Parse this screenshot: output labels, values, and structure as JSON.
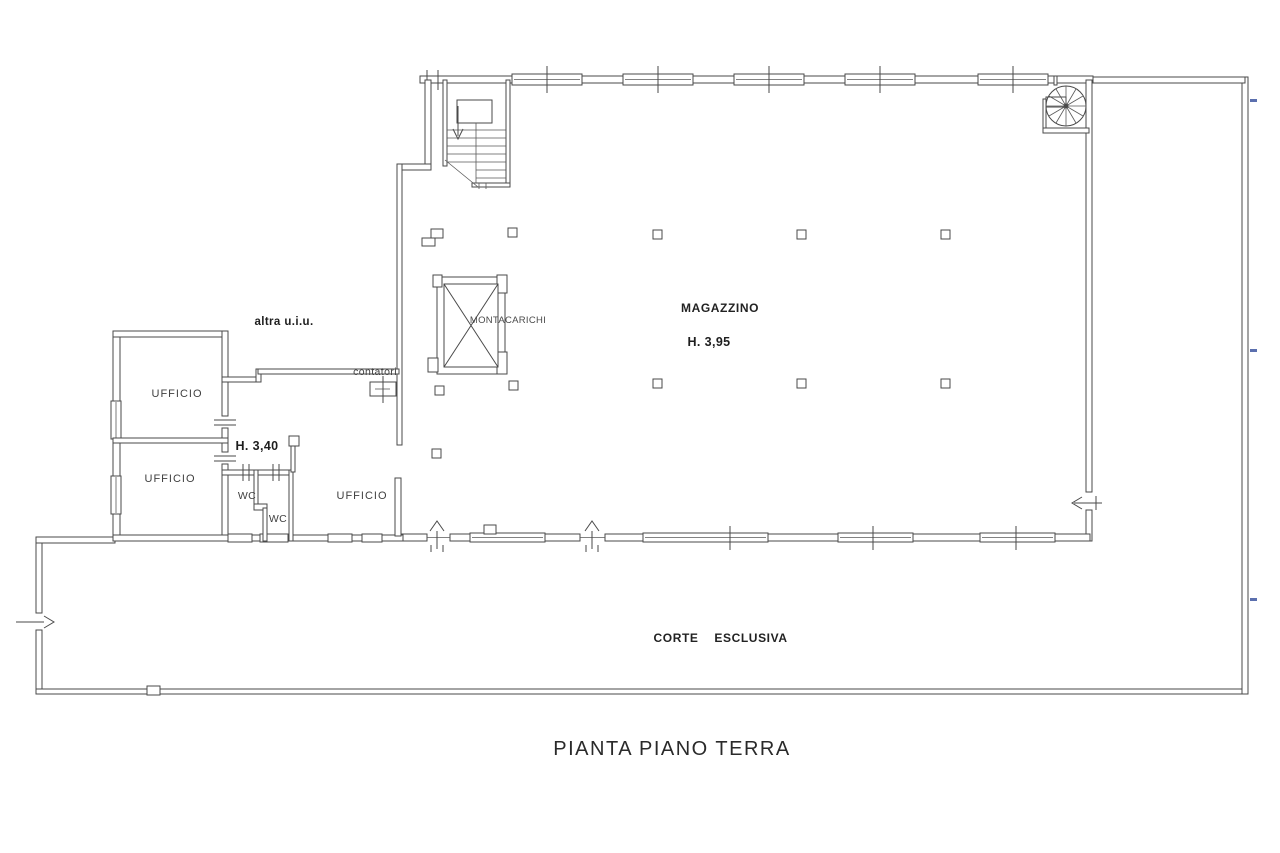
{
  "page": {
    "title": "PIANTA PIANO TERRA",
    "background": "#ffffff"
  },
  "colors": {
    "wall_line": "#4a4a4a",
    "label_text": "#3f3f3f",
    "title_text": "#2a2a2a",
    "annotation_blue": "#5b6fae"
  },
  "warehouse": {
    "name": "MAGAZZINO",
    "height_note": "H. 3,95"
  },
  "elevator": {
    "label": "MONTACARICHI"
  },
  "offices": {
    "height_note": "H. 3,40",
    "office_top_left": "UFFICIO",
    "office_bottom_left": "UFFICIO",
    "office_right": "UFFICIO",
    "wc_top": "WC",
    "wc_bottom": "WC"
  },
  "annotations": {
    "other_unit": "altra u.i.u.",
    "meters": "contatori"
  },
  "courtyard": {
    "label_word1": "CORTE",
    "label_word2": "ESCLUSIVA"
  }
}
